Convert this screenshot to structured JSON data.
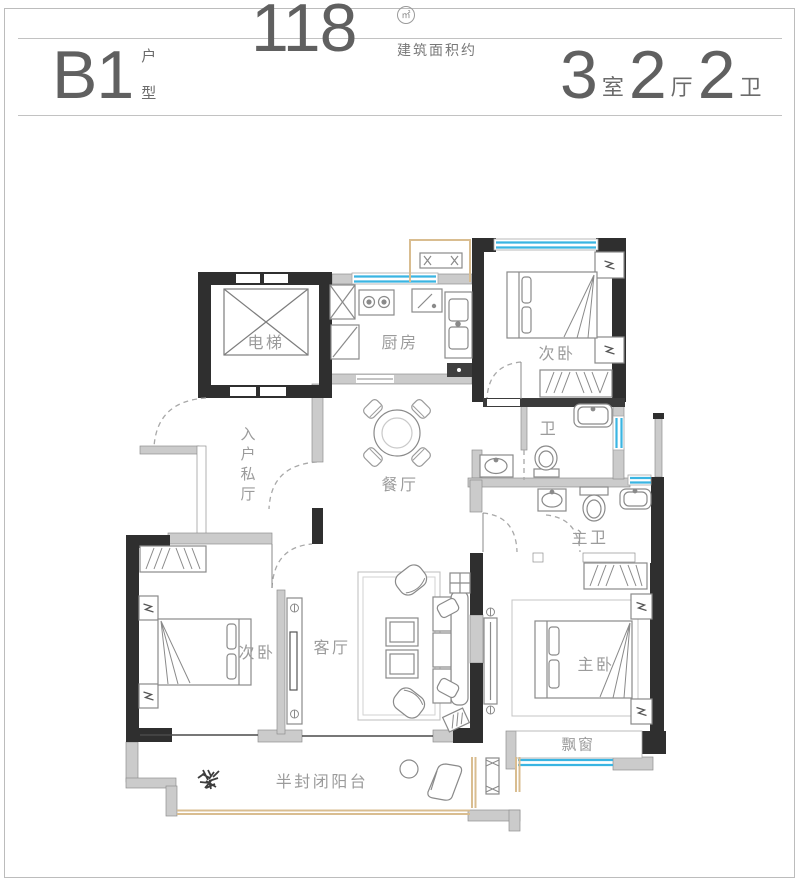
{
  "header": {
    "unit": {
      "code": "B1",
      "suffix_top": "户",
      "suffix_bottom": "型"
    },
    "area": {
      "value": "118",
      "unit": "㎡",
      "note": "建筑面积约"
    },
    "layout": {
      "parts": [
        {
          "num": "3",
          "unit": "室"
        },
        {
          "num": "2",
          "unit": "厅"
        },
        {
          "num": "2",
          "unit": "卫"
        }
      ]
    }
  },
  "rooms": {
    "elevator": {
      "label": "电梯"
    },
    "kitchen": {
      "label": "厨房"
    },
    "bedroom_top": {
      "label": "次卧"
    },
    "bath": {
      "label": "卫"
    },
    "entry": {
      "label": "入户私厅"
    },
    "dining": {
      "label": "餐厅"
    },
    "master_bath": {
      "label": "主卫"
    },
    "bedroom_left": {
      "label": "次卧"
    },
    "living": {
      "label": "客厅"
    },
    "master_bedroom": {
      "label": "主卧"
    },
    "bay_window": {
      "label": "飘窗"
    },
    "balcony": {
      "label": "半封闭阳台"
    }
  },
  "colors": {
    "wall_dark": "#2f2f2f",
    "wall_light": "#cbcbcb",
    "window_blue": "#3ab5e2",
    "balcony_tan": "#d9bd90",
    "furniture_line": "#8a8a8a",
    "label_text": "#9b9b9b",
    "header_text": "#606060",
    "rule_line": "#c2c2c2"
  }
}
